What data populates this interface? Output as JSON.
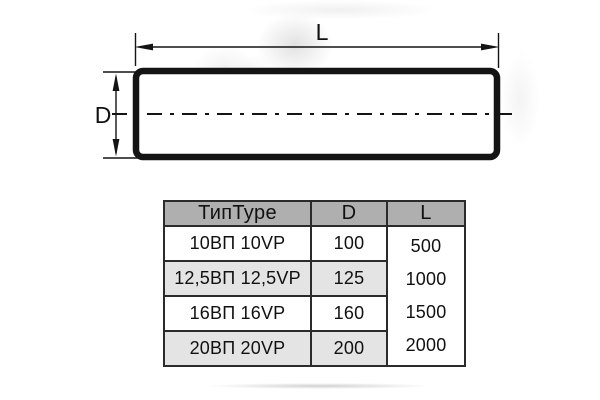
{
  "diagram": {
    "length_label": "L",
    "diameter_label": "D"
  },
  "table": {
    "headers": {
      "type": "ТипType",
      "diameter": "D",
      "length": "L"
    },
    "rows": [
      {
        "type": "10ВП 10VP",
        "d": "100"
      },
      {
        "type": "12,5ВП 12,5VP",
        "d": "125"
      },
      {
        "type": "16ВП 16VP",
        "d": "160"
      },
      {
        "type": "20ВП 20VP",
        "d": "200"
      }
    ],
    "length_values": [
      "500",
      "1000",
      "1500",
      "2000"
    ]
  },
  "colors": {
    "header_bg": "#afafaf",
    "row_alt_bg": "#e4e4e4",
    "table_border": "#2b2b2b",
    "line_color": "#141414"
  }
}
